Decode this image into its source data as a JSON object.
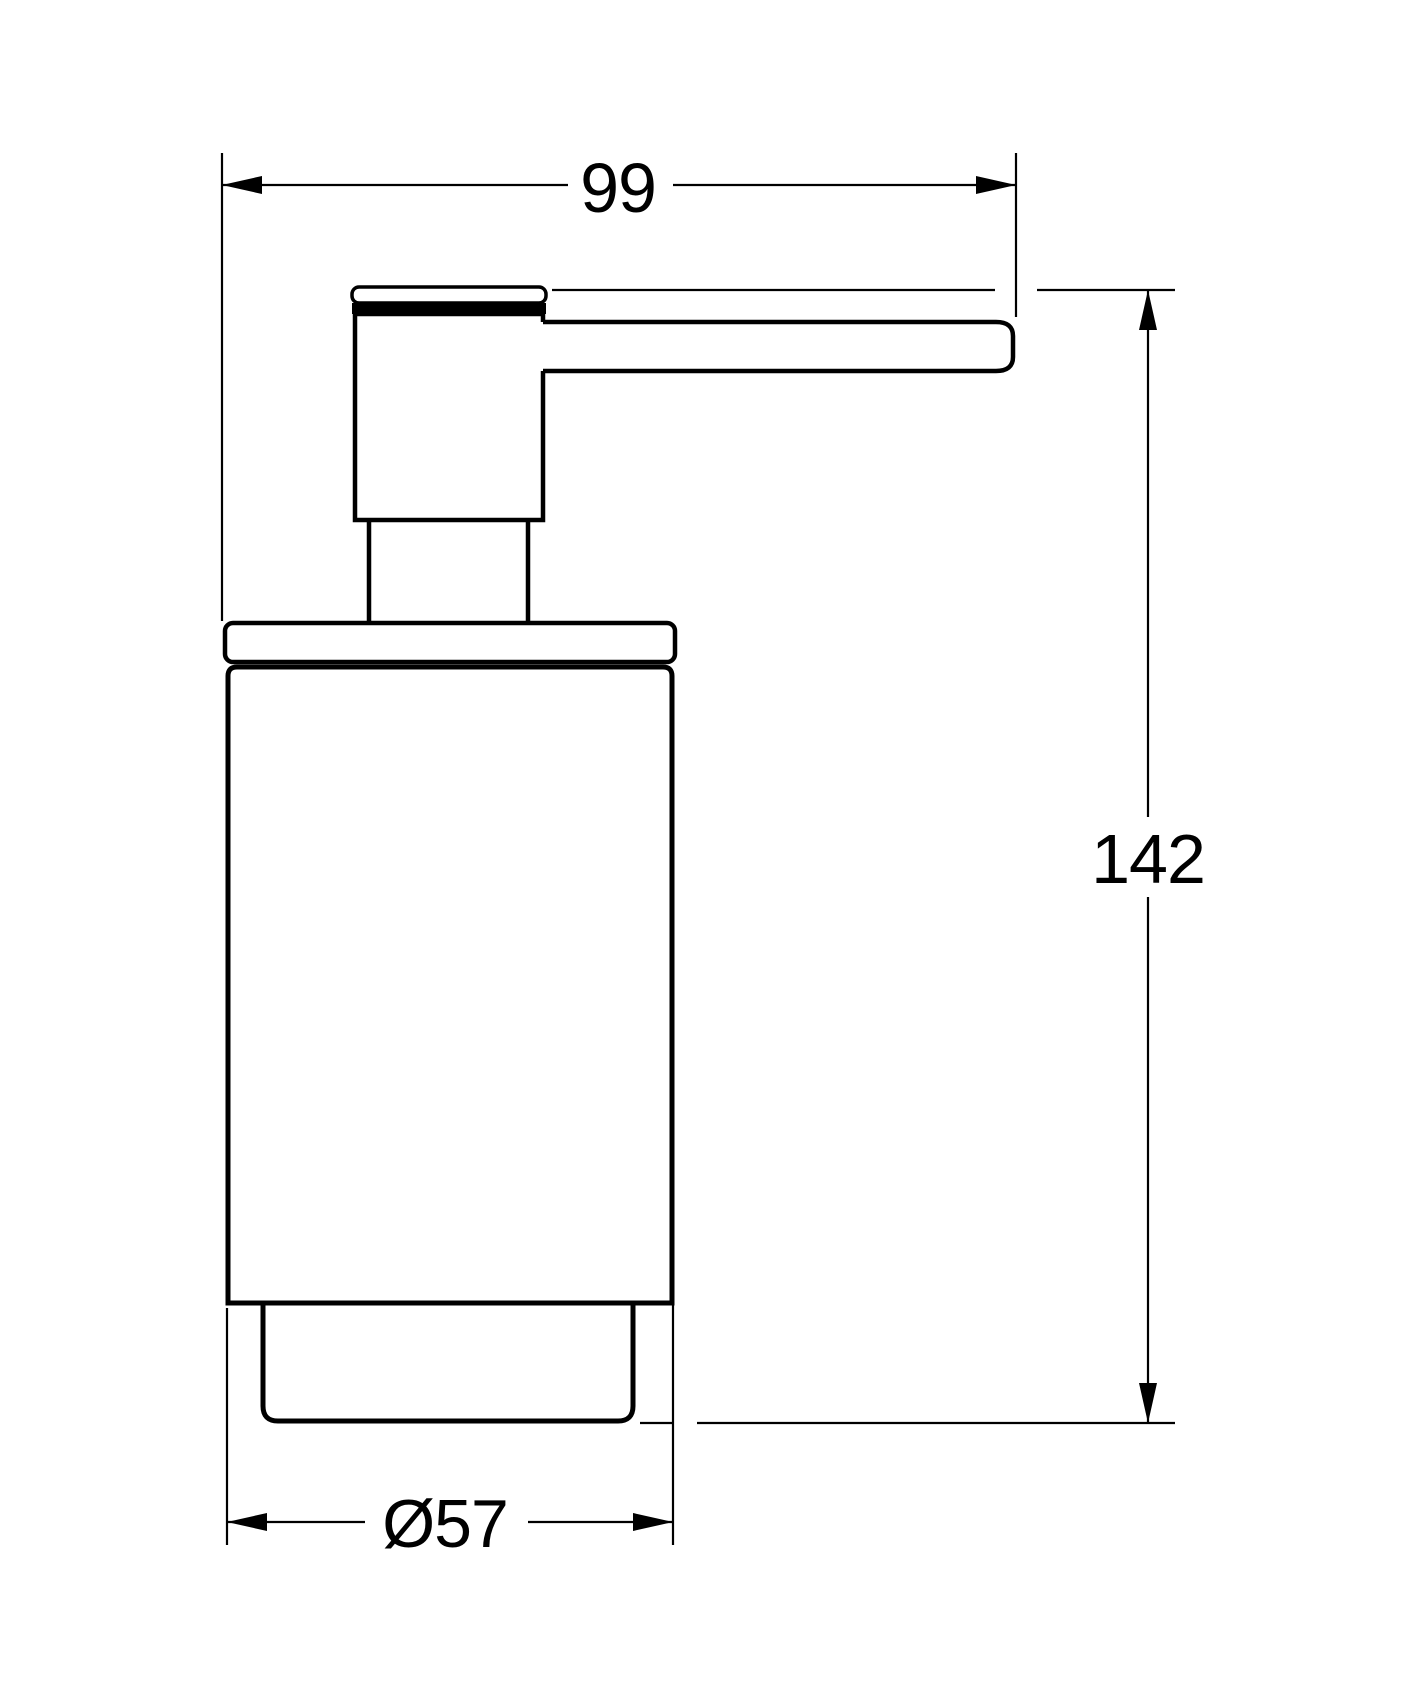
{
  "drawing": {
    "background_color": "#ffffff",
    "line_color": "#000000",
    "subject": "soap-dispenser-side-view",
    "dimensions": {
      "width": {
        "label": "99"
      },
      "height": {
        "label": "142"
      },
      "diameter": {
        "label": "Ø57"
      }
    }
  }
}
